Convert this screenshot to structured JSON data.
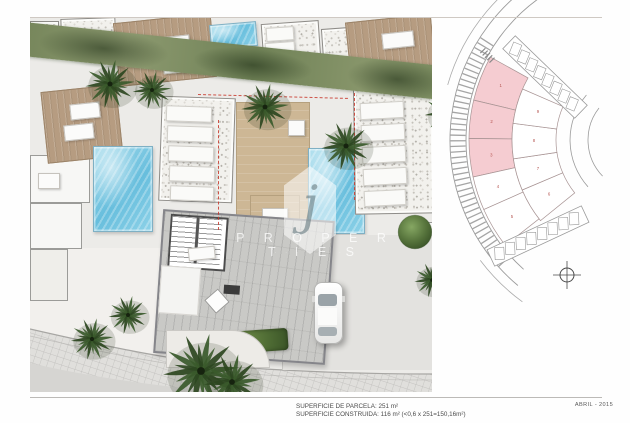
{
  "footer": {
    "superficie_parcela": "SUPERFICIE DE PARCELA: 251 m²",
    "superficie_construida": "SUPERFICIE CONSTRUIDA: 116 m² (<0,6 x 251=150,16m²)",
    "date": "ABRIL - 2015"
  },
  "watermark": {
    "logo_letter": "j",
    "brand": "P R O P E R T I E S",
    "subtext": "· · · · · · · ·"
  },
  "site_diagram": {
    "highlight_color": "#f5ccd1",
    "plot_fill": "#ffffff",
    "outline_color": "#a89494",
    "number_color": "#b5534f",
    "plots": [
      {
        "number": "1",
        "ring": "inner",
        "a0": 193.5,
        "a1": 209.0,
        "highlighted": true
      },
      {
        "number": "2",
        "ring": "inner",
        "a0": 180.5,
        "a1": 193.5,
        "highlighted": true
      },
      {
        "number": "3",
        "ring": "inner",
        "a0": 167.5,
        "a1": 180.5,
        "highlighted": true
      },
      {
        "number": "4",
        "ring": "inner",
        "a0": 156.0,
        "a1": 167.5,
        "highlighted": false
      },
      {
        "number": "5",
        "ring": "inner",
        "a0": 142.0,
        "a1": 156.0,
        "highlighted": false
      },
      {
        "number": "6",
        "ring": "outer",
        "a0": 141.0,
        "a1": 157.0,
        "highlighted": false
      },
      {
        "number": "7",
        "ring": "outer",
        "a0": 157.0,
        "a1": 171.5,
        "highlighted": false
      },
      {
        "number": "8",
        "ring": "outer",
        "a0": 171.5,
        "a1": 187.5,
        "highlighted": false
      },
      {
        "number": "9",
        "ring": "outer",
        "a0": 187.5,
        "a1": 203.5,
        "highlighted": false
      }
    ]
  }
}
